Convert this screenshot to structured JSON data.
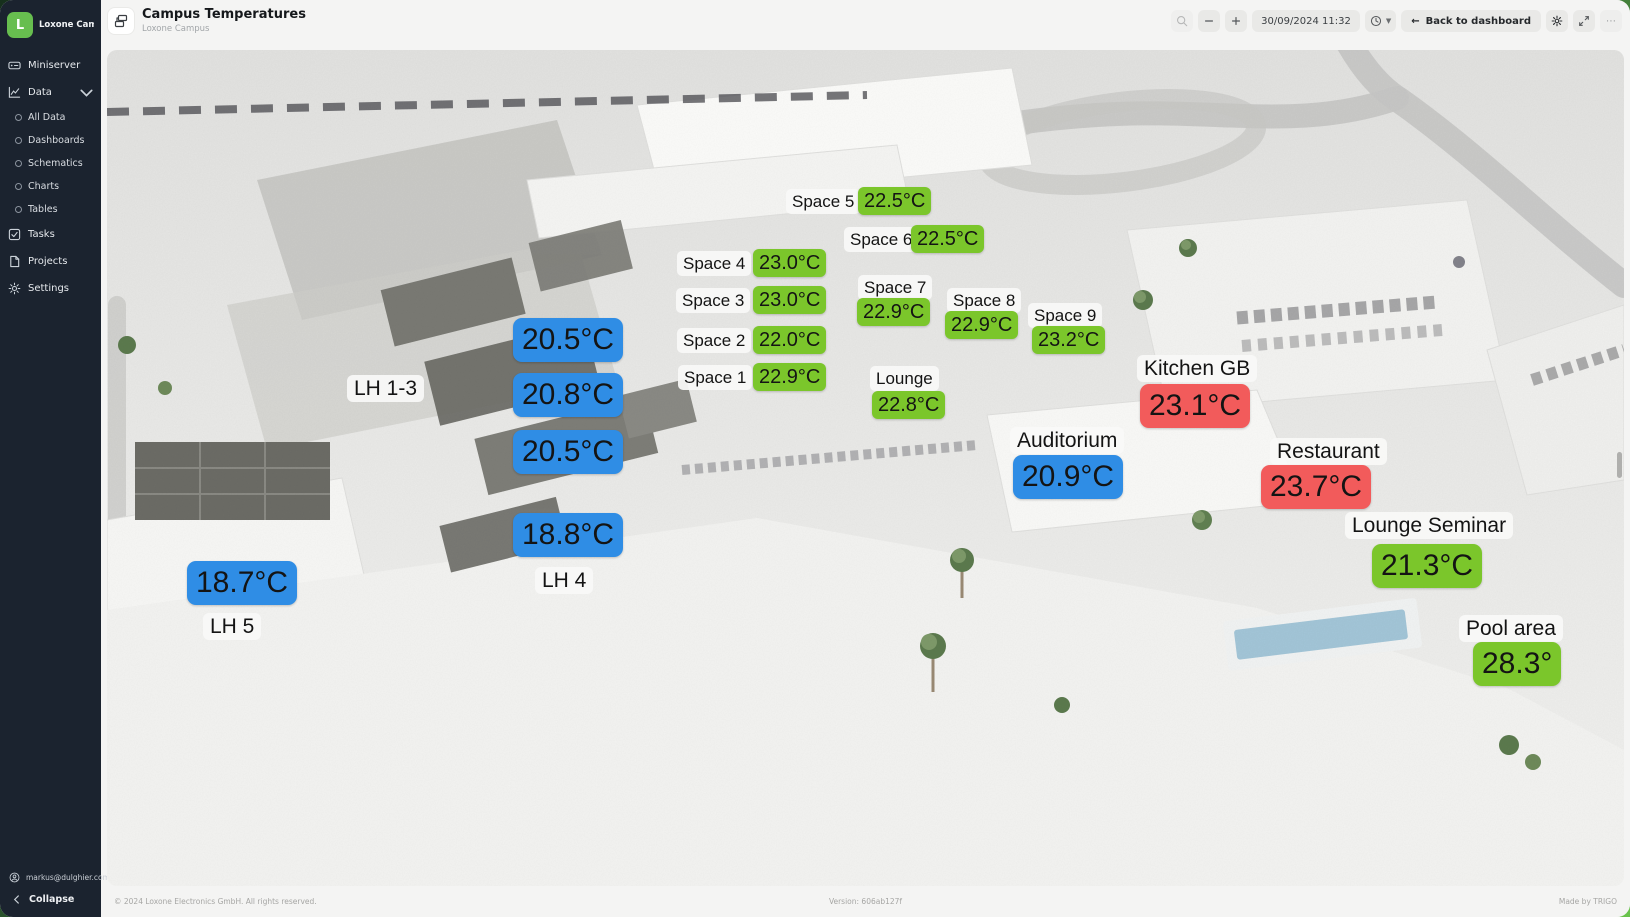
{
  "sidebar": {
    "logo_letter": "L",
    "workspace": "Loxone Campus...",
    "nav": [
      {
        "label": "Miniserver"
      },
      {
        "label": "Data"
      }
    ],
    "data_children": [
      {
        "label": "All Data"
      },
      {
        "label": "Dashboards"
      },
      {
        "label": "Schematics"
      },
      {
        "label": "Charts"
      },
      {
        "label": "Tables"
      }
    ],
    "tools": [
      {
        "label": "Tasks"
      },
      {
        "label": "Projects"
      },
      {
        "label": "Settings"
      }
    ],
    "user_email": "markus@dulghier.com",
    "collapse_label": "Collapse"
  },
  "header": {
    "title": "Campus Temperatures",
    "subtitle": "Loxone Campus",
    "datetime": "30/09/2024 11:32",
    "back_arrow": "←",
    "back_label": "Back to dashboard",
    "more_label": "⋯"
  },
  "footer": {
    "copyright": "© 2024 Loxone Electronics GmbH. All rights reserved.",
    "version": "Version: 606ab127f",
    "credit": "Made by TRIGO"
  },
  "colors": {
    "sensor_green": "#7BC62B",
    "sensor_blue": "#2F8DE5",
    "sensor_red": "#F25B5B",
    "brand_green": "#69C350",
    "sidebar_bg": "#1B232F"
  },
  "overlays": [
    {
      "kind": "name",
      "text": "Space 5",
      "size": "sm",
      "x": 679,
      "y": 139
    },
    {
      "kind": "value",
      "text": "22.5°C",
      "color": "green",
      "size": "sm",
      "x": 751,
      "y": 137
    },
    {
      "kind": "name",
      "text": "Space 6",
      "size": "sm",
      "x": 737,
      "y": 177
    },
    {
      "kind": "value",
      "text": "22.5°C",
      "color": "green",
      "size": "sm",
      "x": 804,
      "y": 175
    },
    {
      "kind": "name",
      "text": "Space 4",
      "size": "sm",
      "x": 570,
      "y": 201
    },
    {
      "kind": "value",
      "text": "23.0°C",
      "color": "green",
      "size": "sm",
      "x": 646,
      "y": 199
    },
    {
      "kind": "name",
      "text": "Space 3",
      "size": "sm",
      "x": 569,
      "y": 238
    },
    {
      "kind": "value",
      "text": "23.0°C",
      "color": "green",
      "size": "sm",
      "x": 646,
      "y": 236
    },
    {
      "kind": "name",
      "text": "Space 2",
      "size": "sm",
      "x": 570,
      "y": 278
    },
    {
      "kind": "value",
      "text": "22.0°C",
      "color": "green",
      "size": "sm",
      "x": 646,
      "y": 276
    },
    {
      "kind": "name",
      "text": "Space 1",
      "size": "sm",
      "x": 571,
      "y": 315
    },
    {
      "kind": "value",
      "text": "22.9°C",
      "color": "green",
      "size": "sm",
      "x": 646,
      "y": 313
    },
    {
      "kind": "name",
      "text": "Space 7",
      "size": "sm",
      "x": 751,
      "y": 225
    },
    {
      "kind": "value",
      "text": "22.9°C",
      "color": "green",
      "size": "sm",
      "x": 750,
      "y": 248
    },
    {
      "kind": "name",
      "text": "Space 8",
      "size": "sm",
      "x": 840,
      "y": 238
    },
    {
      "kind": "value",
      "text": "22.9°C",
      "color": "green",
      "size": "sm",
      "x": 838,
      "y": 261
    },
    {
      "kind": "name",
      "text": "Space 9",
      "size": "sm",
      "x": 921,
      "y": 253
    },
    {
      "kind": "value",
      "text": "23.2°C",
      "color": "green",
      "size": "sm",
      "x": 925,
      "y": 276
    },
    {
      "kind": "name",
      "text": "Lounge",
      "size": "sm",
      "x": 763,
      "y": 316
    },
    {
      "kind": "value",
      "text": "22.8°C",
      "color": "green",
      "size": "sm",
      "x": 765,
      "y": 341
    },
    {
      "kind": "name",
      "text": "Kitchen GB",
      "size": "lg",
      "x": 1030,
      "y": 305
    },
    {
      "kind": "value",
      "text": "23.1°C",
      "color": "red",
      "size": "lg",
      "x": 1033,
      "y": 334
    },
    {
      "kind": "name",
      "text": "Auditorium",
      "size": "lg",
      "x": 903,
      "y": 377
    },
    {
      "kind": "value",
      "text": "20.9°C",
      "color": "blue",
      "size": "lg",
      "x": 906,
      "y": 405
    },
    {
      "kind": "name",
      "text": "Restaurant",
      "size": "lg",
      "x": 1163,
      "y": 388
    },
    {
      "kind": "value",
      "text": "23.7°C",
      "color": "red",
      "size": "lg",
      "x": 1154,
      "y": 415
    },
    {
      "kind": "name",
      "text": "Lounge Seminar",
      "size": "lg",
      "x": 1238,
      "y": 462
    },
    {
      "kind": "value",
      "text": "21.3°C",
      "color": "green",
      "size": "lg",
      "x": 1265,
      "y": 494
    },
    {
      "kind": "name",
      "text": "Pool area",
      "size": "lg",
      "x": 1352,
      "y": 565
    },
    {
      "kind": "value",
      "text": "28.3°",
      "color": "green",
      "size": "lg",
      "x": 1366,
      "y": 592
    },
    {
      "kind": "name",
      "text": "LH 1-3",
      "size": "lg",
      "x": 240,
      "y": 325
    },
    {
      "kind": "value",
      "text": "20.5°C",
      "color": "blue",
      "size": "lg",
      "x": 406,
      "y": 268
    },
    {
      "kind": "value",
      "text": "20.8°C",
      "color": "blue",
      "size": "lg",
      "x": 406,
      "y": 323
    },
    {
      "kind": "value",
      "text": "20.5°C",
      "color": "blue",
      "size": "lg",
      "x": 406,
      "y": 380
    },
    {
      "kind": "value",
      "text": "18.8°C",
      "color": "blue",
      "size": "lg",
      "x": 406,
      "y": 463
    },
    {
      "kind": "name",
      "text": "LH 4",
      "size": "lg",
      "x": 428,
      "y": 517
    },
    {
      "kind": "value",
      "text": "18.7°C",
      "color": "blue",
      "size": "lg",
      "x": 80,
      "y": 511
    },
    {
      "kind": "name",
      "text": "LH 5",
      "size": "lg",
      "x": 96,
      "y": 563
    }
  ]
}
